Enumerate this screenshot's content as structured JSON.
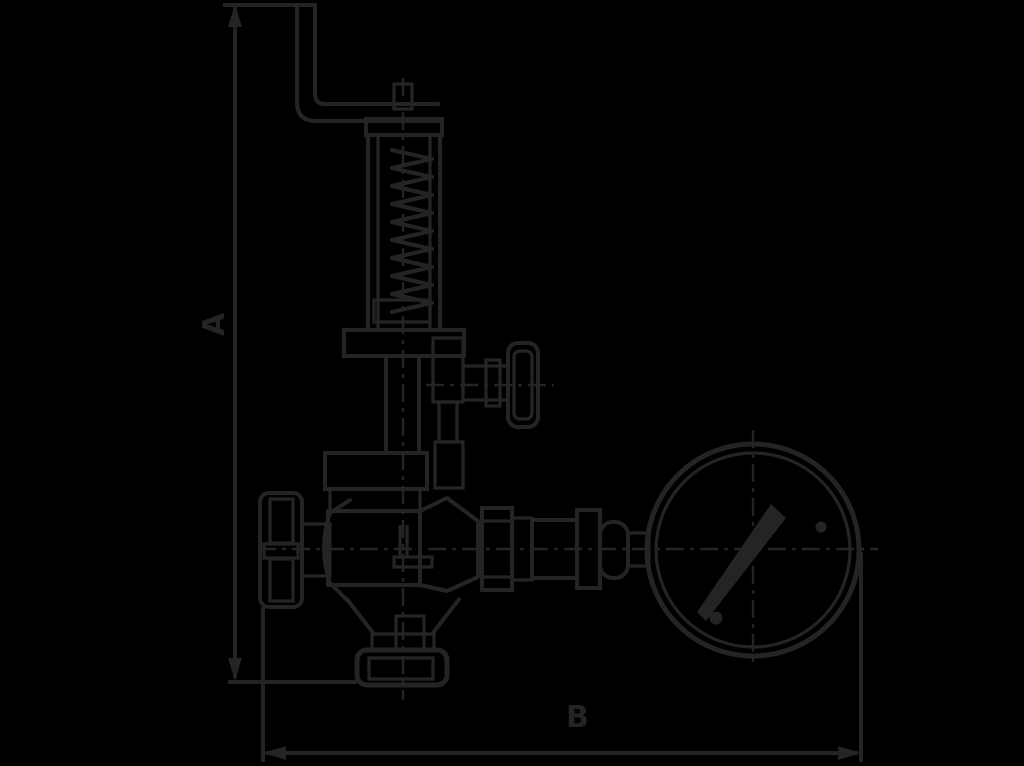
{
  "page": {
    "background": "#000000"
  },
  "drawing": {
    "ink_color": "#242424",
    "kind": "technical dimension drawing",
    "subject": "spring-loaded safety relief valve with lifting lever, shut-off hand knob, test knob and pressure gauge",
    "labels": {
      "dim_vertical": "A",
      "dim_horizontal": "B"
    },
    "parts": [
      "dimension-a",
      "dimension-b",
      "lifting-lever",
      "spindle-cap",
      "spring-bonnet",
      "coil-spring",
      "bonnet-flange",
      "valve-neck",
      "union-nut",
      "valve-body",
      "hand-knob-left",
      "test-knob-right",
      "outlet-fittings",
      "pressure-gauge",
      "gauge-needle",
      "bottom-flange",
      "centerlines"
    ]
  }
}
